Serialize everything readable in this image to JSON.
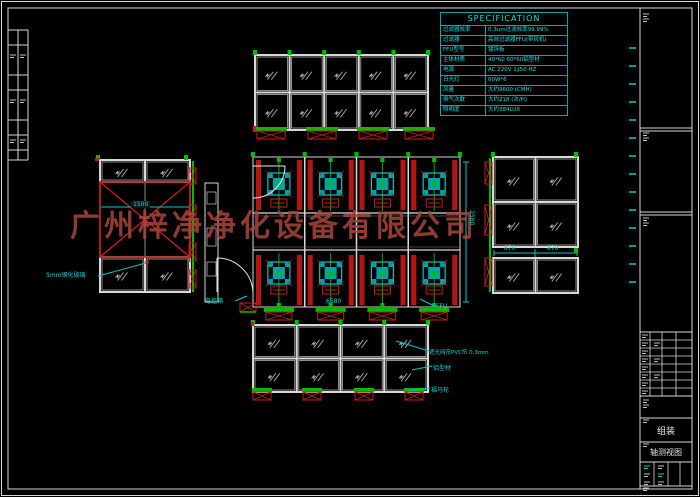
{
  "watermark": {
    "text": "广州梓净净化设备有限公司",
    "color": "#a8463a"
  },
  "spec_table": {
    "title": "SPECIFICATION",
    "border_color": "#00a8a8",
    "text_color": "#00e0e0",
    "rows": [
      {
        "label": "过滤器效率",
        "value": "0.3um过滤效率99.99%"
      },
      {
        "label": "过滤器",
        "value": "高效过滤器FFU(带风机)"
      },
      {
        "label": "FFU型号",
        "value": "镀锌板"
      },
      {
        "label": "主体材质",
        "value": "40*60 60*60铝型材"
      },
      {
        "label": "电源",
        "value": "AC 220V 1∮50 HZ"
      },
      {
        "label": "日光灯",
        "value": "60W*6"
      },
      {
        "label": "风量",
        "value": "大约9600 (CMH)"
      },
      {
        "label": "换气次数",
        "value": "大约218 (次/H)"
      },
      {
        "label": "照明度",
        "value": "大约384LUX"
      }
    ]
  },
  "callouts": {
    "ffu": "FFU",
    "shade_net": "遮光网帘PVC帘 0.3mm",
    "aluminum": "铝型材",
    "caster": "福马轮",
    "glass": "5mm钢化玻璃",
    "control_box": "电控箱"
  },
  "dimensions": {
    "plan_width": "6580",
    "plan_height": "2580",
    "left_panel": "1500",
    "right_panel_a": "870",
    "right_panel_b": "870"
  },
  "title_block": {
    "assembly": "组装",
    "view_name": "轴测视图"
  },
  "colors": {
    "line_white": "#d8d8d8",
    "line_red": "#c41e1e",
    "line_green": "#00bc00",
    "line_cyan": "#00c8c8",
    "background": "#000000"
  }
}
